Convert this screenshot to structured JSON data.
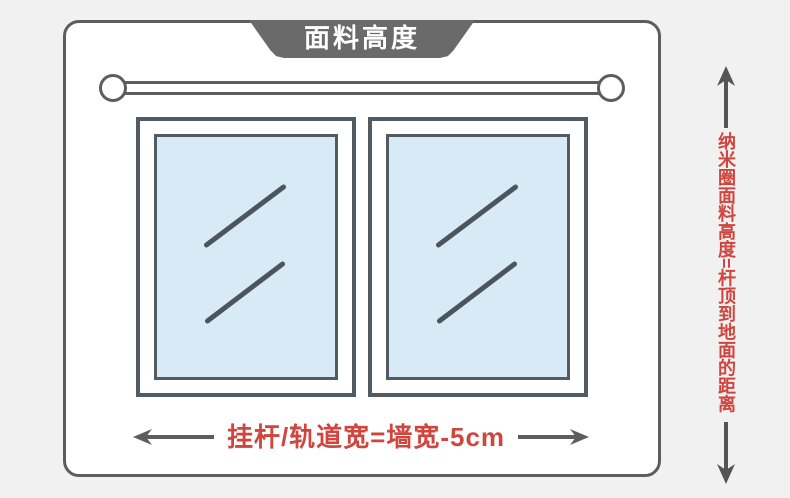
{
  "banner": {
    "label": "面料高度"
  },
  "bottom_measure": {
    "label": "挂杆/轨道宽=墙宽-5cm"
  },
  "side_note": {
    "label": "纳米圈面料高度=杆顶到地面的距离"
  },
  "colors": {
    "outline": "#5d5d5d",
    "banner": "#6a6a6a",
    "frame": "#535b62",
    "glass": "#d8eaf6",
    "glassline": "#4d555c",
    "red": "#d0453e",
    "bg": "#f1f1f2"
  },
  "icons": {
    "width_arrow_left": "arrow-left-icon",
    "width_arrow_right": "arrow-right-icon",
    "height_arrow_up": "arrow-up-icon",
    "height_arrow_down": "arrow-down-icon"
  }
}
